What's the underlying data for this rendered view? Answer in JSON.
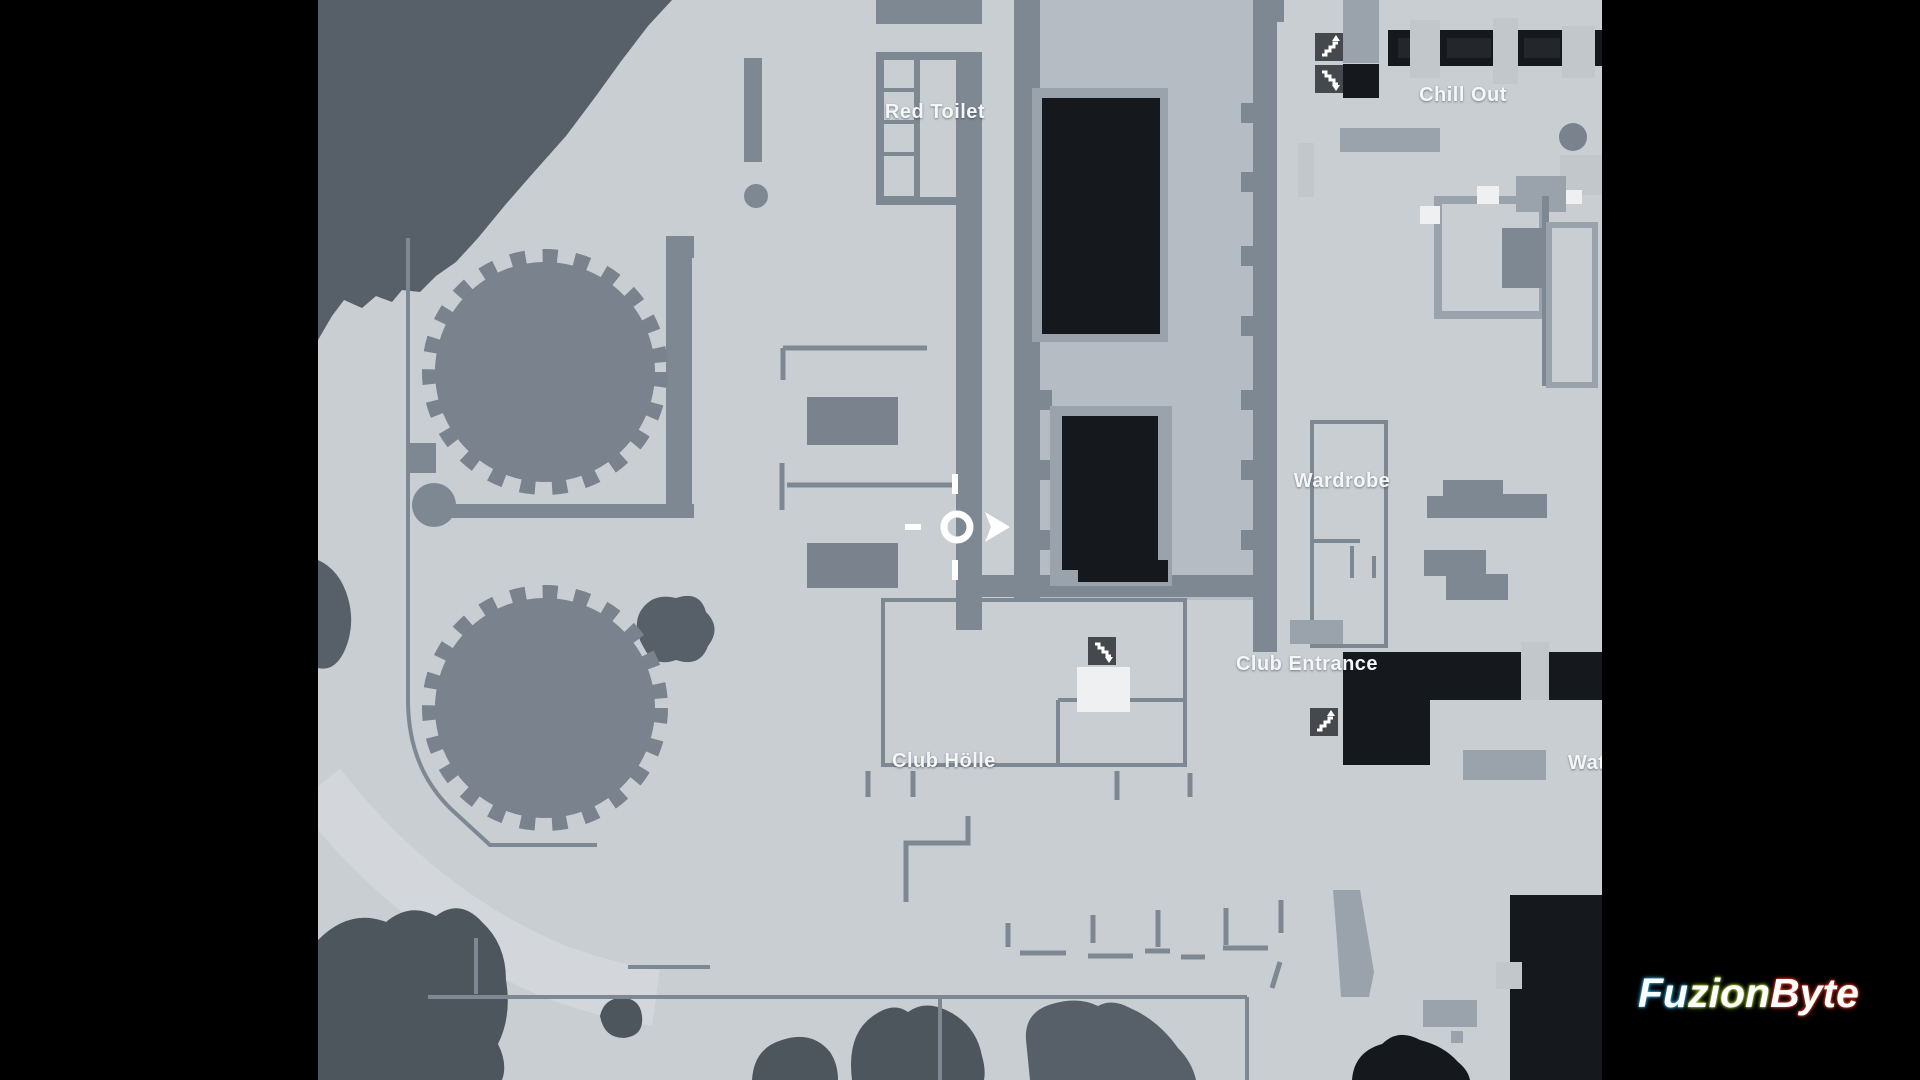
{
  "window": {
    "type": "game-map-overlay",
    "view": "club-level-floor-plan"
  },
  "map": {
    "labels": {
      "red_toilet": "Red Toilet",
      "chill_out": "Chill Out",
      "wardrobe": "Wardrobe",
      "club_entrance": "Club Entrance",
      "club_holle": "Club Hölle",
      "water_partial": "Wat"
    },
    "markers": {
      "player": {
        "x": 957,
        "y": 527,
        "facing": "east",
        "shape": "circle-with-arrow"
      },
      "stairs": [
        {
          "name": "stairs-up",
          "area": "chill-out"
        },
        {
          "name": "stairs-down",
          "area": "chill-out"
        },
        {
          "name": "stairs-down",
          "area": "club-holle"
        },
        {
          "name": "stairs-up",
          "area": "club-entrance"
        }
      ]
    },
    "colors": {
      "letterbox": "#000000",
      "floor": "#c9ced3",
      "floor_interior": "#b6bcc3",
      "wall": "#7e8893",
      "wall_light": "#9aa2ab",
      "pillar": "#c2c7cc",
      "structure": "#79828d",
      "terrain": "#575f68",
      "foliage": "#4d555d",
      "room_black": "#15181c",
      "room_black_inner": "#23272c",
      "icon_bg": "#45494e",
      "door_white": "#eef0f2",
      "road": "#d3d7db",
      "label_text": "#f4f6f7"
    }
  },
  "watermark": {
    "text": "FuzionByte",
    "segments": [
      {
        "text": "Fu",
        "glow_color": "#33b3f0"
      },
      {
        "text": "zion",
        "glow_color": "#a8d832"
      },
      {
        "text": "Byte",
        "glow_color": "#ef3b25"
      }
    ]
  }
}
